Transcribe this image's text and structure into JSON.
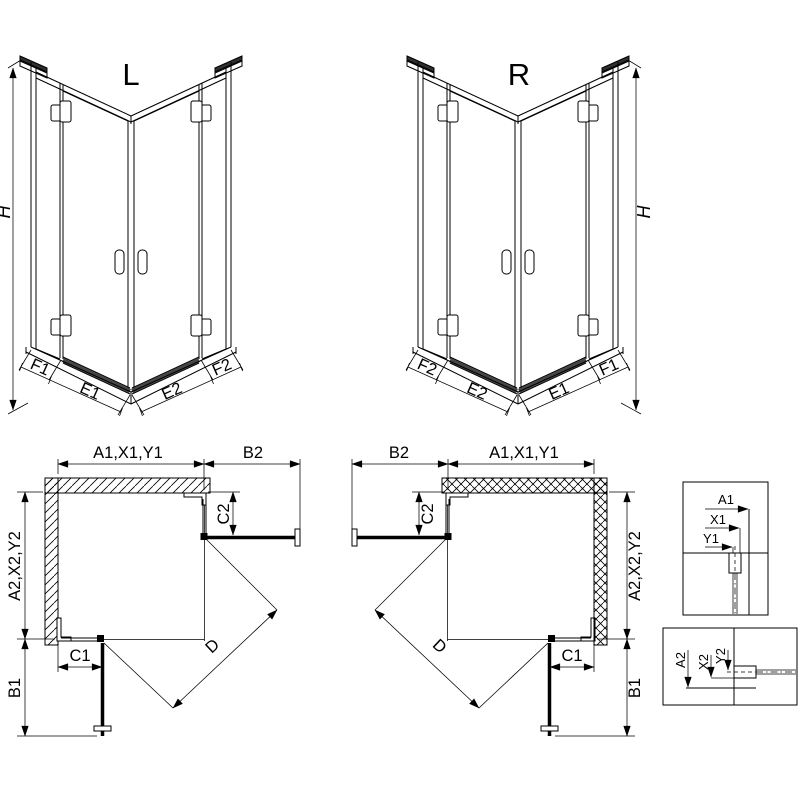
{
  "drawing": {
    "type": "shower-enclosure-technical-drawing",
    "colors": {
      "background": "#ffffff",
      "line": "#000000",
      "seal": "#454545"
    }
  },
  "perspective_views": {
    "left": {
      "label": "L",
      "height": "H",
      "bottom": [
        "F1",
        "E1",
        "E2",
        "F2"
      ]
    },
    "right": {
      "label": "R",
      "height": "H",
      "bottom": [
        "F2",
        "E2",
        "E1",
        "F1"
      ]
    }
  },
  "plan_views": {
    "left": {
      "width": "A1,X1,Y1",
      "door_width": "B2",
      "fixed_return": "C2",
      "depth": "A2,X2,Y2",
      "fixed_side": "C1",
      "door_depth": "B1",
      "diagonal": "D"
    },
    "right": {
      "width": "A1,X1,Y1",
      "door_width": "B2",
      "fixed_return": "C2",
      "depth": "A2,X2,Y2",
      "fixed_side": "C1",
      "door_depth": "B1",
      "diagonal": "D"
    }
  },
  "details": {
    "width_section": [
      "A1",
      "X1",
      "Y1"
    ],
    "depth_section": [
      "A2",
      "X2",
      "Y2"
    ]
  }
}
